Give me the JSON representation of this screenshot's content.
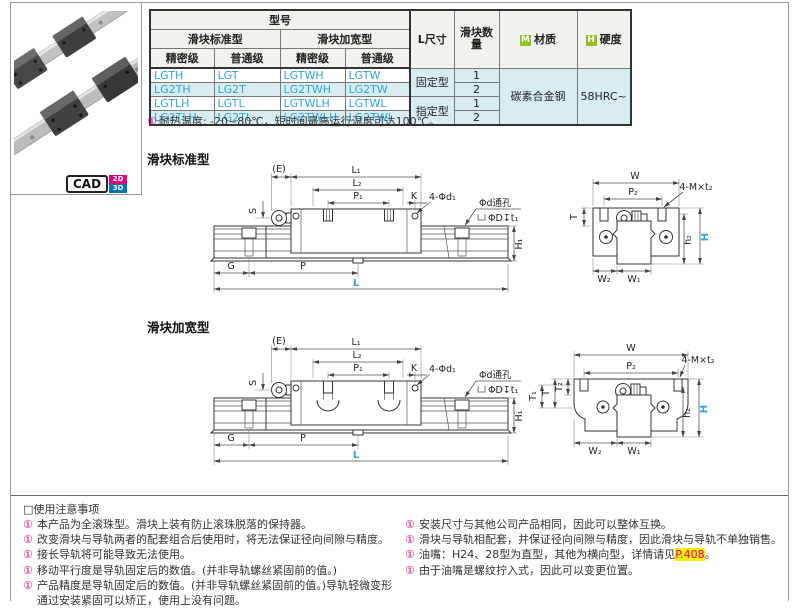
{
  "cad": {
    "label": "CAD",
    "badge_2d": "2D",
    "badge_3d": "3D"
  },
  "table": {
    "headers": {
      "model_group": "型号",
      "standard": "滑块标准型",
      "wide": "滑块加宽型",
      "precision": "精密级",
      "normal": "普通级",
      "l_size": "L尺寸",
      "qty": "滑块数量",
      "material_badge": "M",
      "material": "材质",
      "hardness_badge": "H",
      "hardness": "硬度"
    },
    "rows": [
      {
        "std_precision": "LGTH",
        "std_normal": "LGT",
        "wide_precision": "LGTWH",
        "wide_normal": "LGTW",
        "qty": "1"
      },
      {
        "std_precision": "LG2TH",
        "std_normal": "LG2T",
        "wide_precision": "LG2TWH",
        "wide_normal": "LG2TW",
        "qty": "2"
      },
      {
        "std_precision": "LGTLH",
        "std_normal": "LGTL",
        "wide_precision": "LGTWLH",
        "wide_normal": "LGTWL",
        "qty": "1"
      },
      {
        "std_precision": "LG2TLH",
        "std_normal": "LG2TL",
        "wide_precision": "LG2TWLH",
        "wide_normal": "LG2TWL",
        "qty": "2"
      }
    ],
    "l_fixed": "固定型",
    "l_specified": "指定型",
    "material_value": "碳素合金钢",
    "hardness_value": "58HRC~"
  },
  "table_note": {
    "marker": "①",
    "text": "耐热温度: -20~80℃，短时间最高运行温度可达100℃。"
  },
  "sections": {
    "standard_title": "滑块标准型",
    "wide_title": "滑块加宽型"
  },
  "dims": {
    "e": "(E)",
    "l1": "L₁",
    "l2": "L₂",
    "p1": "P₁",
    "k": "K",
    "d1": "4-Φd₁",
    "s": "S",
    "hole": "Φd通孔",
    "cbore": "ΦD↧t₁",
    "h1": "H₁",
    "g": "G",
    "p": "P",
    "l": "L",
    "w": "W",
    "p2": "P₂",
    "mt2": "4-M×t₂",
    "t": "T",
    "t1": "T₁",
    "t2": "T₂",
    "h2": "h₂",
    "h": "H",
    "w1": "W₁",
    "w2": "W₂"
  },
  "notes": {
    "title": "□使用注意事项",
    "marker": "①",
    "left": [
      "本产品为全滚珠型。滑块上装有防止滚珠脱落的保持器。",
      "改变滑块与导轨两者的配套组合后使用时，将无法保证径向间隙与精度。",
      "接长导轨将可能导致无法使用。",
      "移动平行度是导轨固定后的数值。(并非导轨螺丝紧固前的值。)",
      "产品精度是导轨固定后的数值。(并非导轨螺丝紧固前的值。)导轨轻微变形通过安装紧固可以矫正，使用上没有问题。"
    ],
    "right": [
      {
        "pre": "安装尺寸与其他公司产品相同，因此可以整体互换。",
        "link": "",
        "post": ""
      },
      {
        "pre": "滑块与导轨相配套，并保证径向间隙与精度，因此滑块与导轨不单独销售。",
        "link": "",
        "post": ""
      },
      {
        "pre": "油嘴：H24、28型为直型，其他为横向型，详情请见",
        "link": "P.408",
        "post": "。"
      },
      {
        "pre": "由于油嘴是螺纹拧入式，因此可以变更位置。",
        "link": "",
        "post": ""
      }
    ]
  }
}
